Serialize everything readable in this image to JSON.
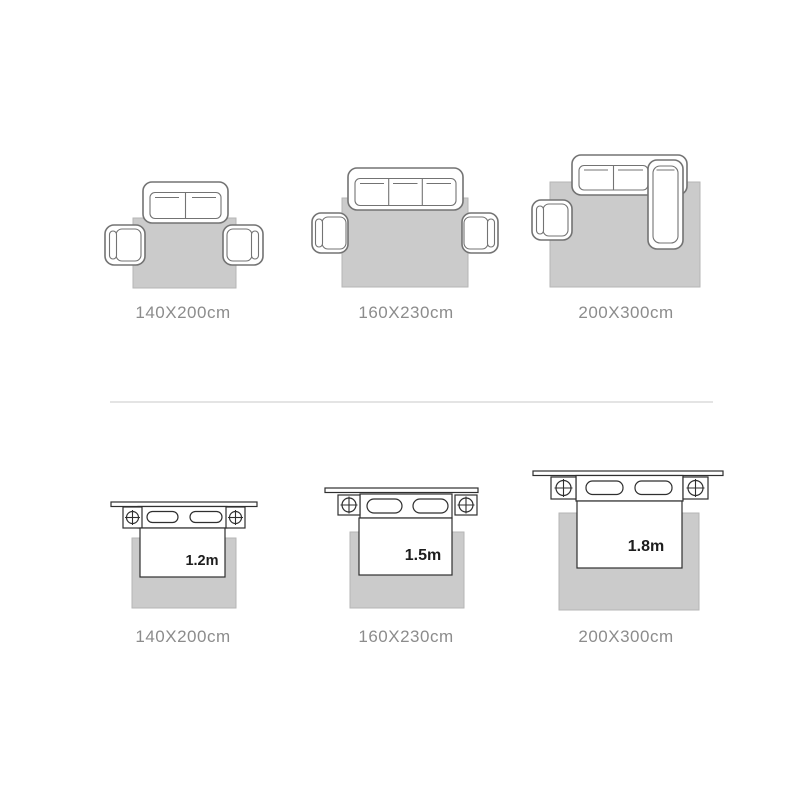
{
  "colors": {
    "background": "#ffffff",
    "rug_fill": "#cbcbcb",
    "rug_border": "#b6b6b6",
    "sofa_outline": "#737373",
    "bed_outline": "#2f2f2f",
    "label_text": "#8c8c8c",
    "bed_size_text": "#1d1d1d",
    "divider": "#e4e4e4"
  },
  "sofa_row": {
    "items": [
      {
        "type": "two-seat-sofa-with-armchairs-rug-diagram",
        "label": "140X200cm"
      },
      {
        "type": "three-seat-sofa-with-armchairs-rug-diagram",
        "label": "160X230cm"
      },
      {
        "type": "sectional-sofa-with-chaise-and-armchair-rug-diagram",
        "label": "200X300cm"
      }
    ]
  },
  "bed_row": {
    "items": [
      {
        "type": "bed-with-nightstands-rug-diagram",
        "bed_width": "1.2m",
        "label": "140X200cm"
      },
      {
        "type": "bed-with-nightstands-rug-diagram",
        "bed_width": "1.5m",
        "label": "160X230cm"
      },
      {
        "type": "bed-with-nightstands-rug-diagram",
        "bed_width": "1.8m",
        "label": "200X300cm"
      }
    ]
  }
}
